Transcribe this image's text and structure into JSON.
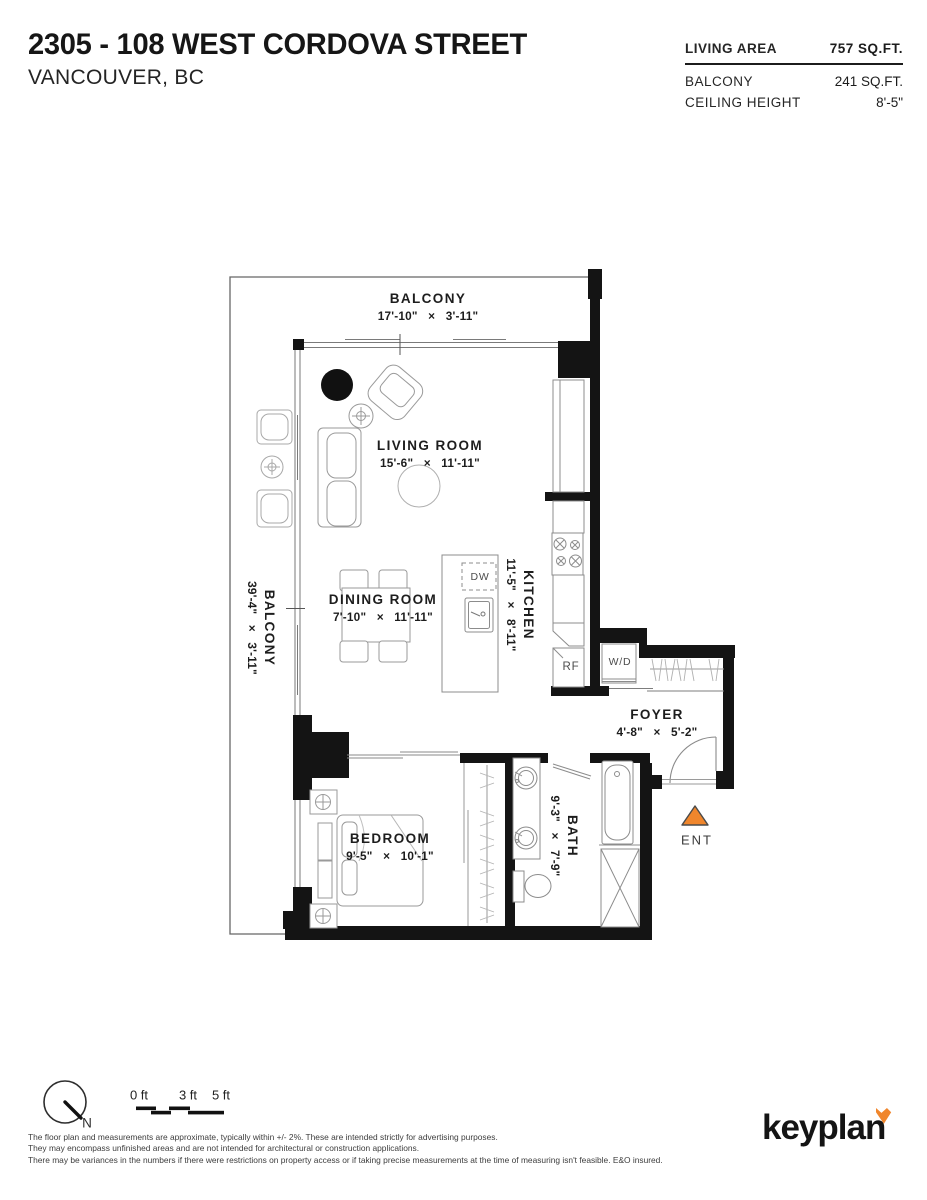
{
  "header": {
    "title": "2305 - 108 WEST CORDOVA STREET",
    "subtitle": "VANCOUVER, BC",
    "stats": [
      {
        "label": "LIVING AREA",
        "value": "757 SQ.FT."
      },
      {
        "label": "BALCONY",
        "value": "241 SQ.FT."
      },
      {
        "label": "CEILING HEIGHT",
        "value": "8'-5\""
      }
    ]
  },
  "plan": {
    "rooms": [
      {
        "name": "BALCONY",
        "dims": "17'-10\" × 3'-11\"",
        "orientation": "horizontal"
      },
      {
        "name": "LIVING ROOM",
        "dims": "15'-6\" × 11'-11\"",
        "orientation": "horizontal"
      },
      {
        "name": "DINING ROOM",
        "dims": "7'-10\" × 11'-11\"",
        "orientation": "horizontal"
      },
      {
        "name": "KITCHEN",
        "dims": "11'-5\" × 8'-11\"",
        "orientation": "vertical"
      },
      {
        "name": "BALCONY",
        "dims": "39'-4\" × 3'-11\"",
        "orientation": "vertical"
      },
      {
        "name": "FOYER",
        "dims": "4'-8\" × 5'-2\"",
        "orientation": "horizontal"
      },
      {
        "name": "BEDROOM",
        "dims": "9'-5\" × 10'-1\"",
        "orientation": "horizontal"
      },
      {
        "name": "BATH",
        "dims": "9'-3\" × 7'-9\"",
        "orientation": "vertical"
      }
    ],
    "fixtures": {
      "dw": "DW",
      "rf": "RF",
      "wd": "W/D",
      "ent": "ENT"
    }
  },
  "footer": {
    "north": "N",
    "scale": [
      "0 ft",
      "3 ft",
      "5 ft"
    ],
    "disclaimer": [
      "The floor plan and measurements are approximate, typically within +/- 2%. These are intended strictly for advertising purposes.",
      "They may encompass unfinished areas and are not intended for architectural or construction applications.",
      "There may be variances in the numbers if there were restrictions on property access or if taking precise measurements at the time of measuring isn't feasible. E&O insured."
    ],
    "logo": "keyplan"
  },
  "colors": {
    "accent_orange": "#F0862C",
    "wall": "#141414"
  }
}
